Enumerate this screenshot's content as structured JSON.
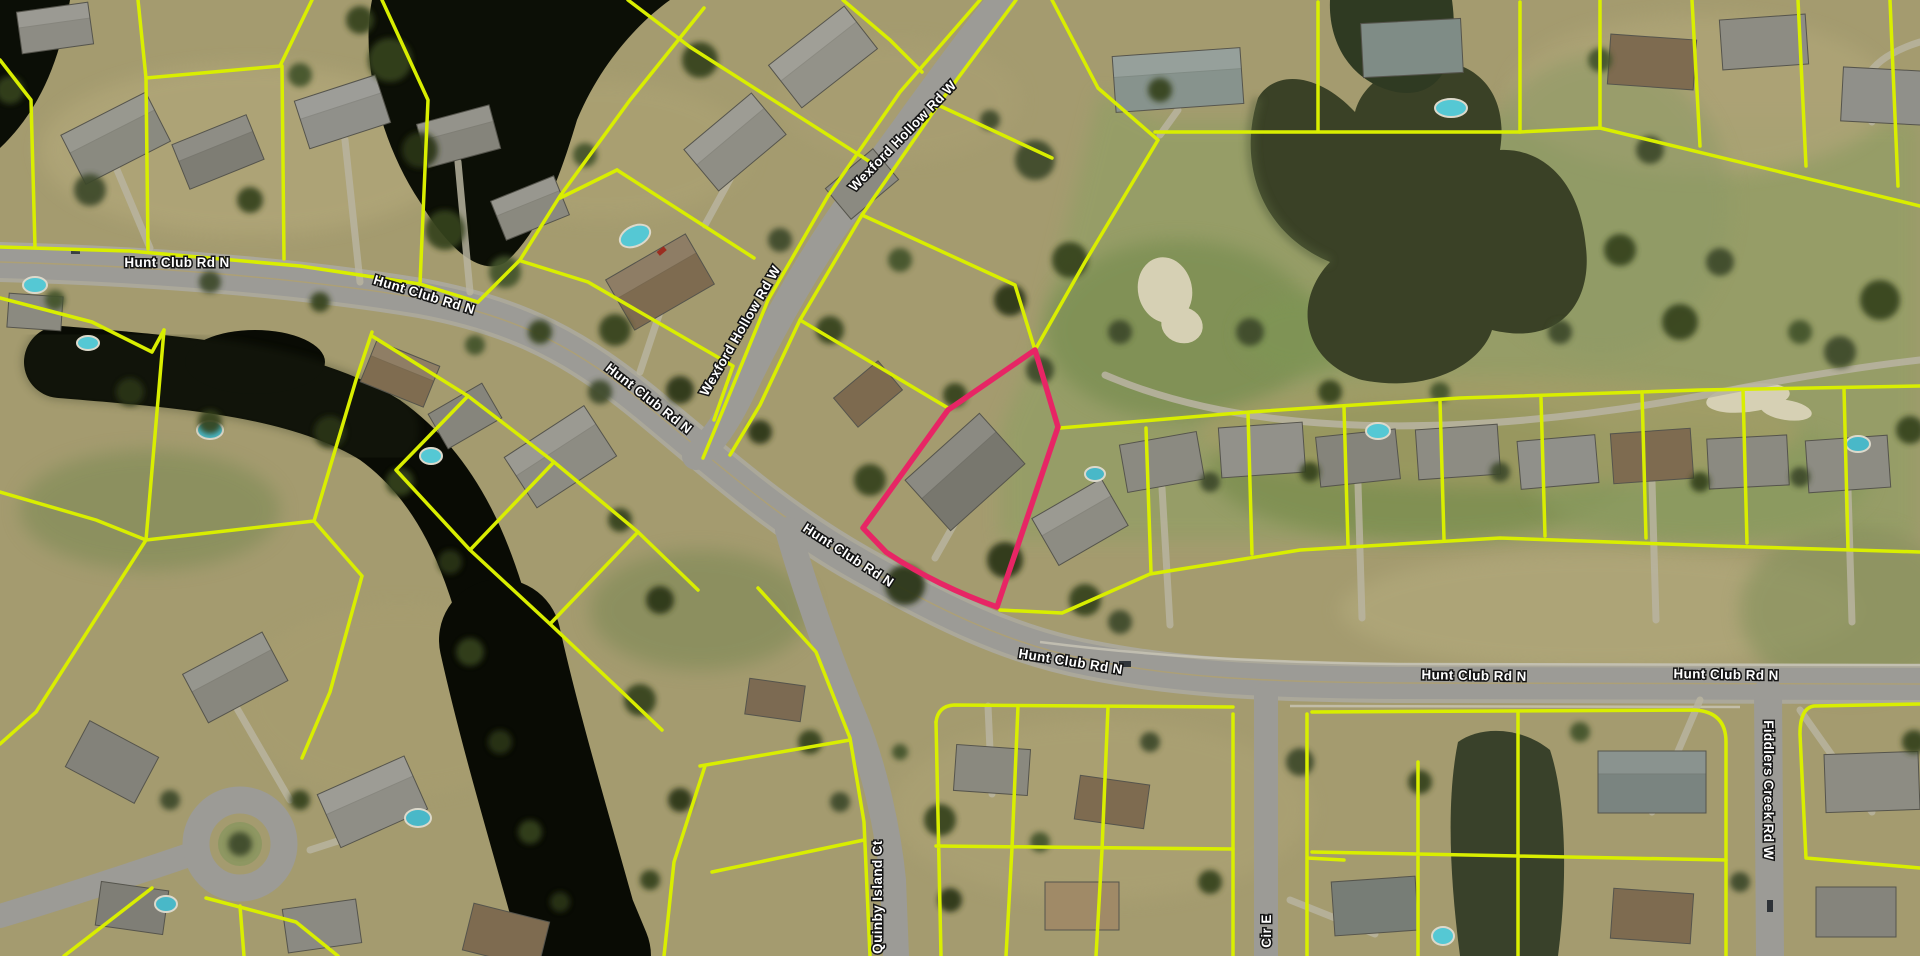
{
  "map": {
    "description": "Aerial parcel map with selected lot highlighted",
    "colors": {
      "highlight": "#E72565",
      "parcel_line": "#D9EE00",
      "label_fill": "#FFFFFF",
      "label_stroke": "#141414"
    },
    "selected_parcel": {
      "outline_color": "#E72565"
    },
    "road_names": [
      "Hunt Club Rd N",
      "Wexford Hollow Rd W",
      "Quinby Island Ct",
      "Fiddlers Creek Rd W",
      "Cir E"
    ],
    "road_labels": [
      {
        "id": "hunt-club-rd-n-1",
        "text": "Hunt Club Rd N",
        "x": 177,
        "y": 267,
        "rotate": 0
      },
      {
        "id": "hunt-club-rd-n-2",
        "text": "Hunt Club Rd N",
        "x": 423,
        "y": 299,
        "rotate": 17
      },
      {
        "id": "hunt-club-rd-n-3",
        "text": "Hunt Club Rd N",
        "x": 646,
        "y": 402,
        "rotate": 38
      },
      {
        "id": "hunt-club-rd-n-4",
        "text": "Hunt Club Rd N",
        "x": 846,
        "y": 559,
        "rotate": 33
      },
      {
        "id": "hunt-club-rd-n-5",
        "text": "Hunt Club Rd N",
        "x": 1070,
        "y": 666,
        "rotate": 9
      },
      {
        "id": "hunt-club-rd-n-6",
        "text": "Hunt Club Rd N",
        "x": 1474,
        "y": 680,
        "rotate": 1
      },
      {
        "id": "hunt-club-rd-n-7",
        "text": "Hunt Club Rd N",
        "x": 1726,
        "y": 679,
        "rotate": 1
      },
      {
        "id": "wexford-hollow-rd-w-1",
        "text": "Wexford Hollow Rd W",
        "x": 906,
        "y": 139,
        "rotate": -46
      },
      {
        "id": "wexford-hollow-rd-w-2",
        "text": "Wexford Hollow Rd W",
        "x": 744,
        "y": 333,
        "rotate": -60
      },
      {
        "id": "quinby-island-ct",
        "text": "Quinby Island Ct",
        "x": 882,
        "y": 897,
        "rotate": -90
      },
      {
        "id": "fiddlers-creek-rd-w",
        "text": "Fiddlers Creek Rd W",
        "x": 1764,
        "y": 790,
        "rotate": 90
      },
      {
        "id": "cir-e",
        "text": "Cir E",
        "x": 1271,
        "y": 931,
        "rotate": -90
      }
    ]
  }
}
